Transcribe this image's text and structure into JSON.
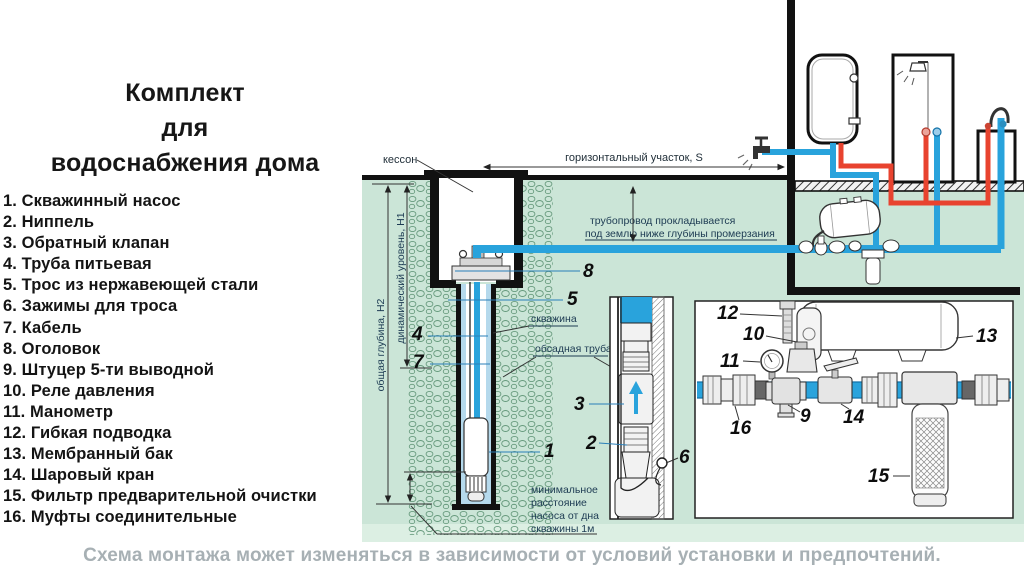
{
  "title_lines": [
    "Комплект",
    "для",
    "водоснабжения дома"
  ],
  "parts": [
    "1. Скважинный насос",
    "2. Ниппель",
    "3. Обратный клапан",
    "4. Труба питьевая",
    "5. Трос из нержавеющей стали",
    "6. Зажимы для троса",
    "7. Кабель",
    "8. Оголовок",
    "9. Штуцер 5-ти выводной",
    "10. Реле давления",
    "11. Манометр",
    "12. Гибкая подводка",
    "13. Мембранный бак",
    "14. Шаровый кран",
    "15. Фильтр предварительной очистки",
    "16. Муфты соединительные"
  ],
  "footer": "Схема монтажа может изменяться в зависимости от условий установки и предпочтений.",
  "diagram": {
    "labels": {
      "caisson": "кессон",
      "horizontal_section": "горизонтальный участок,  S",
      "pipeline_note_1": "трубопровод прокладывается",
      "pipeline_note_2": "под землю ниже глубины промерзания",
      "well": "скважина",
      "casing_pipe": "обсадная труба",
      "total_depth": "общая глубина, Н2",
      "dynamic_level": "динамический уровень, Н1",
      "min_distance_1": "минимальное",
      "min_distance_2": "расстояние",
      "min_distance_3": "насоса от дна",
      "min_distance_4": "скважины 1м"
    },
    "callouts": {
      "c1": "1",
      "c2": "2",
      "c3": "3",
      "c4": "4",
      "c5": "5",
      "c6": "6",
      "c7": "7",
      "c8": "8",
      "c9": "9",
      "c10": "10",
      "c11": "11",
      "c12": "12",
      "c13": "13",
      "c14": "14",
      "c15": "15",
      "c16": "16"
    },
    "colors": {
      "ground_green": "#cbe5d7",
      "pipe_blue": "#29a3dc",
      "pipe_red": "#e8432f",
      "water_light": "#b5d9ec",
      "label_dark": "#1c3a52",
      "caption_gray": "#a7b0b4"
    }
  }
}
